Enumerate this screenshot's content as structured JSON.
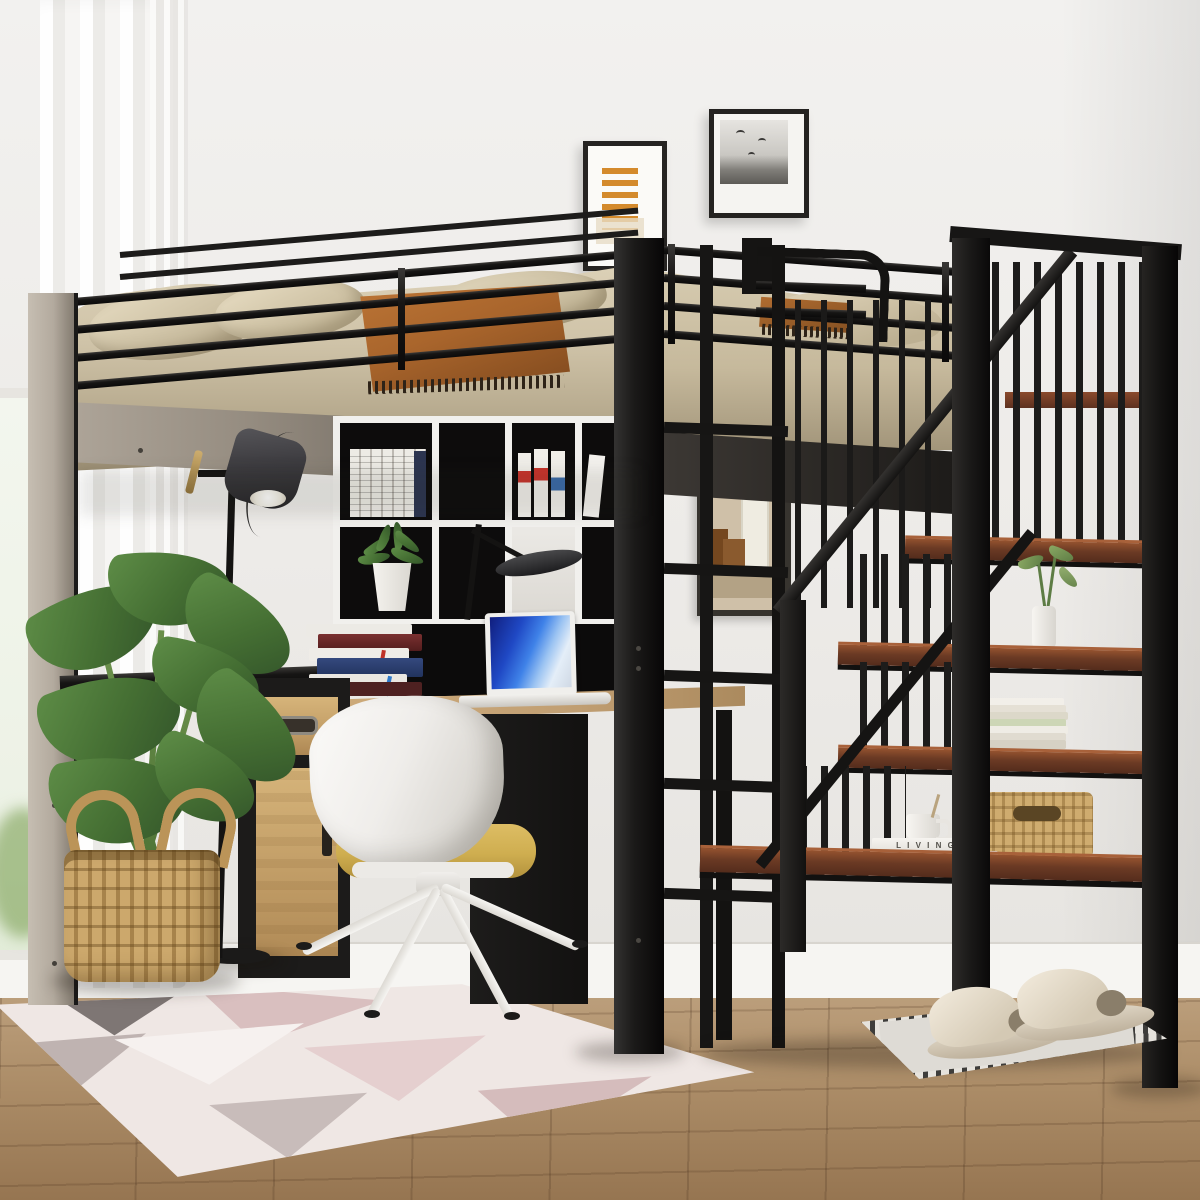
{
  "scene": {
    "title": "Black metal loft bed with storage staircase, desk, shelves and decor",
    "setting": "bright bedroom corner with white walls, sheer curtain window and wood floor"
  },
  "text": {
    "book_spine": "L I V I N G"
  },
  "palette": {
    "frame_black": "#1a1918",
    "post_greige": "#b3aa9e",
    "bedding_beige": "#cfc3a8",
    "throw_rust": "#a9652c",
    "stair_wood": "#6b3a26",
    "desk_wood": "#c2a074",
    "cabinet_wood": "#c9a76d",
    "chair_shell_white": "#f2f0ec",
    "chair_seat_yellow": "#d3b45b",
    "laptop_screen_blue": "#2f6fe0",
    "plant_green": "#4d7c3c",
    "basket_tan": "#c2a068",
    "rug_pink": "#dcc4c4",
    "wall": "#edebe8",
    "floor_wood": "#ab8d6b",
    "mat_gray": "#dcd8d2",
    "slipper_beige": "#e2dac9"
  },
  "objects": {
    "loft_bed": "black metal loft bed with guardrails",
    "bedding": "beige comforter and pillows with rust fringed throw",
    "staircase": "storage staircase with walnut shelves and spindle railing",
    "shelf_items": [
      "green sprig in white vase",
      "stack of cream books",
      "white mug on books",
      "woven seagrass basket"
    ],
    "desk": "under-loft desk with oak top",
    "laptop": "white laptop with blue abstract screen",
    "desk_books": "stack of maroon, navy and white books",
    "cube_shelf": "white cubby hutch with books and succulent",
    "cabinet": "oak drawer cabinet with black frame",
    "chair": "white shell swivel chair with mustard seat",
    "floor_lamp": "black floor lamp with charcoal shade",
    "plant": "large leafy plant in wicker basket",
    "wall_art": [
      "orange stripe abstract print",
      "black and white birds photo",
      "framed interior painting"
    ],
    "rug": "pastel geometric area rug",
    "door_mat": "gray patterned mat with beige slippers",
    "window": "left window with sheer white curtain"
  }
}
